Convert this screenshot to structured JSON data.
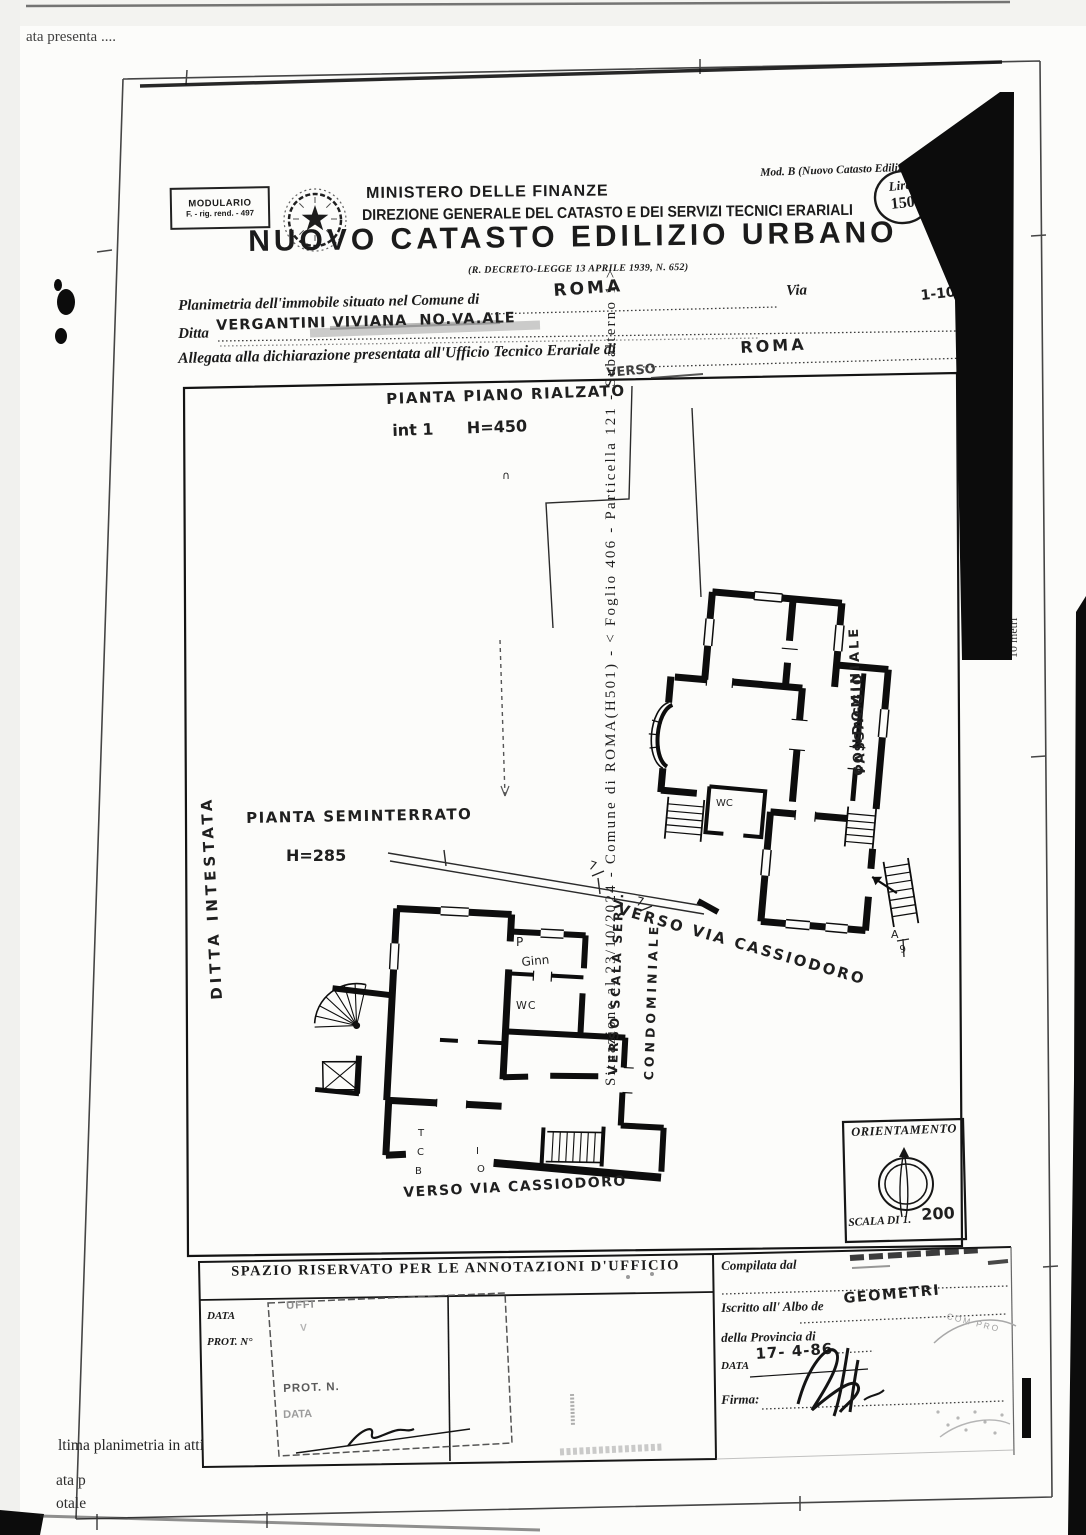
{
  "margins": {
    "top_left_note": "ata presenta ....",
    "bottom_lines": [
      "ltima planimetria in atti",
      "ata p",
      "otale"
    ],
    "right_ref": "Situazione al 23/10/2024 - Comune di ROMA(H501) - < Foglio 406 - Particella 121 - Subalterno 1 >",
    "right_scale": "10 metri"
  },
  "header": {
    "modulario": [
      "MODULARIO",
      "F. - rig. rend. - 497"
    ],
    "mod_b": "Mod. B (Nuovo Catasto Edilizio U",
    "ministry": "MINISTERO DELLE FINANZE",
    "direzione": "DIREZIONE GENERALE DEL CATASTO E DEI SERVIZI TECNICI ERARIALI",
    "title": "NUOVO CATASTO EDILIZIO URBANO",
    "decree": "(R. DECRETO-LEGGE 13 APRILE 1939, N. 652)",
    "lire": [
      "Lire",
      "150"
    ]
  },
  "form": {
    "line1": {
      "label": "Planimetria dell'immobile situato nel Comune di",
      "value": "ROMA",
      "suffix": "Via",
      "right": "1-10"
    },
    "line2": {
      "label": "Ditta",
      "value": "VERGANTINI VIVIANA  NO.VA.ALE"
    },
    "line3": {
      "label": "Allegata alla dichiarazione presentata all'Ufficio Tecnico Erariale di",
      "value": "ROMA"
    }
  },
  "plans": {
    "upper": {
      "title": "PIANTA PIANO RIALZATO",
      "subtitle": "int 1      H=450",
      "top_note": "VERSO",
      "mark": "∩",
      "giardino": "GIARDINO",
      "passaggio": [
        "PASSAGGIO",
        "CONDOMINIALE"
      ],
      "verso_via": "VERSO VIA CASSIODORO",
      "wc": "WC",
      "a_mark": "A",
      "h9": "9",
      "seven_a": "7",
      "seven_b": "7"
    },
    "lower": {
      "title": "PIANTA SEMINTERRATO",
      "subtitle": "H=285",
      "ditta": "DITTA INTESTATA",
      "p": "P",
      "gino": "Ginn",
      "wc": "WC",
      "letters": [
        "T",
        "C",
        "B",
        "I",
        "O"
      ],
      "verso_scala": [
        "VERSO SCALA SERV.",
        "CONDOMINIALE"
      ],
      "verso_via": "VERSO VIA CASSIODORO"
    }
  },
  "orientation": {
    "title": "ORIENTAMENTO",
    "scale_prefix": "SCALA DI 1.",
    "scale_value": "200"
  },
  "office": {
    "spazio": "SPAZIO RISERVATO PER LE ANNOTAZIONI D'UFFICIO",
    "data": "DATA",
    "prot": "PROT. N°",
    "stamp": {
      "uffi": "UFFI",
      "v": "V",
      "prot": "PROT. N.",
      "data": "DATA"
    },
    "compilata": "Compilata dal",
    "iscritto": "Iscritto all' Albo de",
    "albo_value": "GEOMETRI",
    "stamp_arc": "COM PRO",
    "provincia": "della Provincia di",
    "data2": "DATA",
    "data_value": "17- 4-86",
    "firma": "Firma:"
  }
}
